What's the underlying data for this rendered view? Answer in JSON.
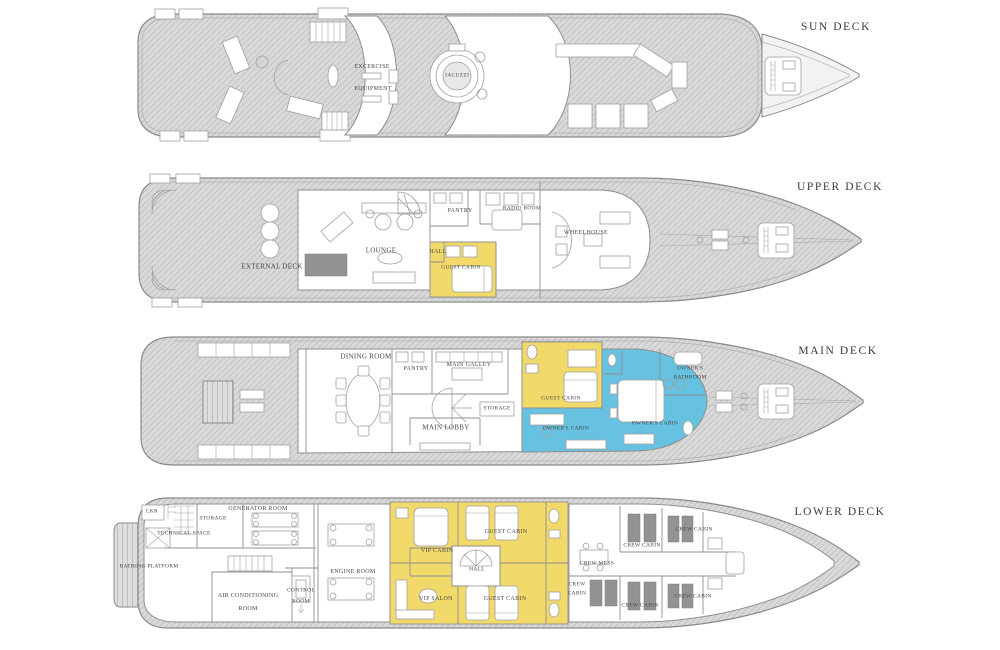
{
  "colors": {
    "guest_cabin_highlight": "#F2DA6A",
    "owner_cabin_highlight": "#66C2E0",
    "deck_shading": "#D8D8D8",
    "outline": "#8A8A8A",
    "label_text": "#474747"
  },
  "decks": {
    "sun": {
      "title": "SUN DECK",
      "rooms": {
        "exercise_line1": "EXCERCISE",
        "exercise_line2": "EQUIPMENT",
        "jacuzzi": "JACUZZI"
      }
    },
    "upper": {
      "title": "UPPER DECK",
      "rooms": {
        "external_deck": "EXTERNAL DECK",
        "lounge": "LOUNGE",
        "pantry": "PANTRY",
        "hall": "HALL",
        "guest_cabin": "GUEST CABIN",
        "radio_room": "RADIO ROOM",
        "wheelhouse": "WHEELHOUSE"
      }
    },
    "main": {
      "title": "MAIN DECK",
      "rooms": {
        "dining_room": "DINING ROOM",
        "pantry": "PANTRY",
        "main_galley": "MAIN GALLEY",
        "storage": "STORAGE",
        "main_lobby": "MAIN LOBBY",
        "guest_cabin": "GUEST CABIN",
        "owners_cabin_aft": "OWNER'S CABIN",
        "owners_cabin_fwd": "OWNER'S CABIN",
        "owners_bathroom_line1": "OWNER'S",
        "owners_bathroom_line2": "BATHROOM"
      }
    },
    "lower": {
      "title": "LOWER DECK",
      "rooms": {
        "lkr": "LKR",
        "storage": "STORAGE",
        "technical_space": "TECHNICAL SPACE",
        "generator_room": "GENERATOR ROOM",
        "bathing_platform": "BATHING PLATFORM",
        "air_conditioning_line1": "AIR CONDITIONING",
        "air_conditioning_line2": "ROOM",
        "control_room_line1": "CONTROL",
        "control_room_line2": "ROOM",
        "engine_room": "ENGINE ROOM",
        "vip_cabin": "VIP CABIN",
        "vip_salon": "VIP SALON",
        "guest_cabin_fwd": "GUEST CABIN",
        "guest_cabin_aft": "GUEST CABIN",
        "hall": "HALL",
        "crew_mess": "CREW MESS",
        "crew_cabin_aft_line1": "CREW",
        "crew_cabin_aft_line2": "CABIN",
        "crew_cabin_mid_upper": "CREW CABIN",
        "crew_cabin_fwd_upper": "CREW CABIN",
        "crew_cabin_mid_lower": "CREW CABIN",
        "crew_cabin_fwd_lower": "CREW CABIN"
      }
    }
  }
}
